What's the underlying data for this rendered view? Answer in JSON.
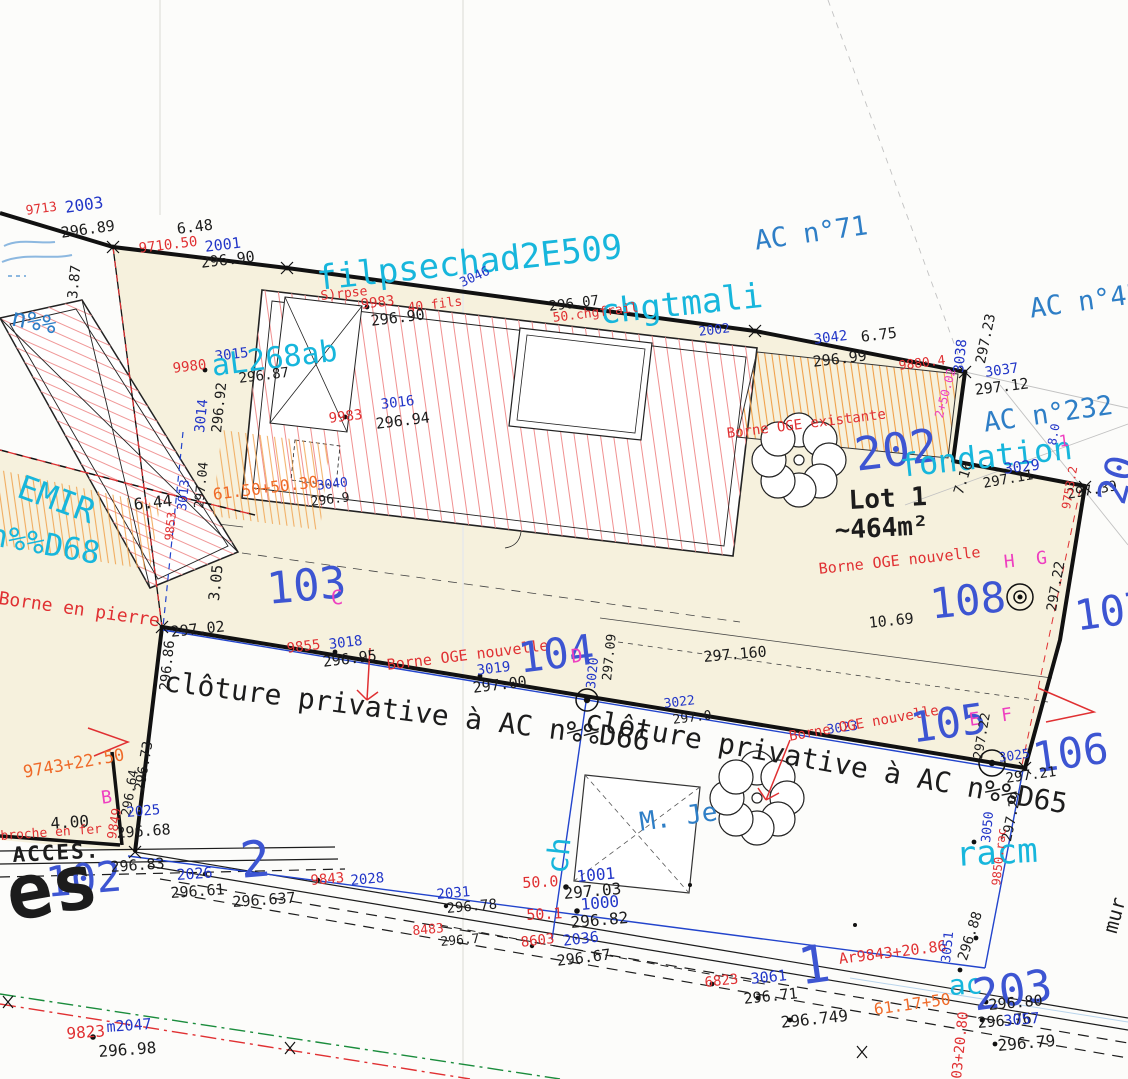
{
  "palette": {
    "point_blue": "#2236c8",
    "survey_red": "#e03032",
    "survey_orange": "#ef6a28",
    "ink_black": "#1c1c1c",
    "overlay_cyan": "#17b6dc",
    "axis_magenta": "#ee3fc0",
    "parcel_ref_blue": "#2e7ec6",
    "parcel_num_blue": "#3d55d2",
    "parcel_beige": "#f6f1dd",
    "hatch_red": "#f09090",
    "hatch_orange": "#f0a048",
    "fence_blue": "#2244cc",
    "axis_green": "#1a8c3c"
  },
  "labels": [
    {
      "t": "9713",
      "x": 25,
      "y": 205,
      "s": 13,
      "c": "red",
      "r": -8
    },
    {
      "t": "2003",
      "x": 64,
      "y": 200,
      "s": 16,
      "c": "blue",
      "r": -8
    },
    {
      "t": "296.89",
      "x": 60,
      "y": 226,
      "s": 15,
      "c": "black",
      "r": -8
    },
    {
      "t": "6.48",
      "x": 176,
      "y": 222,
      "s": 15,
      "c": "black",
      "r": -7,
      "n": "distance-label"
    },
    {
      "t": "9710.50",
      "x": 138,
      "y": 242,
      "s": 14,
      "c": "red",
      "r": -7
    },
    {
      "t": "2001",
      "x": 204,
      "y": 240,
      "s": 15,
      "c": "blue",
      "r": -7
    },
    {
      "t": "296.90",
      "x": 200,
      "y": 256,
      "s": 15,
      "c": "black",
      "r": -7
    },
    {
      "t": "3.87",
      "x": 66,
      "y": 298,
      "s": 14,
      "c": "black",
      "r": -84,
      "n": "distance-label"
    },
    {
      "t": "AC n°71",
      "x": 753,
      "y": 228,
      "s": 27,
      "c": "ac",
      "r": -8
    },
    {
      "t": "AC n°45",
      "x": 1028,
      "y": 296,
      "s": 27,
      "c": "ac",
      "r": -8
    },
    {
      "t": "AC n°232",
      "x": 982,
      "y": 410,
      "s": 27,
      "c": "ac",
      "r": -8
    },
    {
      "t": "filpsechad2E509",
      "x": 315,
      "y": 262,
      "s": 34,
      "c": "cyan",
      "r": -6
    },
    {
      "t": "chgtmali",
      "x": 598,
      "y": 296,
      "s": 34,
      "c": "cyan",
      "r": -6
    },
    {
      "t": "S)rpse",
      "x": 320,
      "y": 290,
      "s": 13,
      "c": "red",
      "r": -6
    },
    {
      "t": "9983",
      "x": 360,
      "y": 298,
      "s": 14,
      "c": "red",
      "r": -7
    },
    {
      "t": "40 fils",
      "x": 407,
      "y": 302,
      "s": 13,
      "c": "red",
      "r": -7
    },
    {
      "t": "296.90",
      "x": 370,
      "y": 314,
      "s": 15,
      "c": "black",
      "r": -7
    },
    {
      "t": "296.07",
      "x": 548,
      "y": 300,
      "s": 14,
      "c": "black",
      "r": -7
    },
    {
      "t": "50.chgfrail",
      "x": 552,
      "y": 312,
      "s": 13,
      "c": "red",
      "r": -7
    },
    {
      "t": "2002",
      "x": 698,
      "y": 326,
      "s": 13,
      "c": "blue",
      "r": -7
    },
    {
      "t": "3046",
      "x": 458,
      "y": 278,
      "s": 13,
      "c": "blue",
      "r": -25
    },
    {
      "t": "3042",
      "x": 813,
      "y": 333,
      "s": 14,
      "c": "blue",
      "r": -7
    },
    {
      "t": "6.75",
      "x": 860,
      "y": 330,
      "s": 15,
      "c": "black",
      "r": -7,
      "n": "distance-label"
    },
    {
      "t": "296.99",
      "x": 812,
      "y": 355,
      "s": 15,
      "c": "black",
      "r": -7
    },
    {
      "t": "9880.4",
      "x": 898,
      "y": 360,
      "s": 13,
      "c": "red",
      "r": -7
    },
    {
      "t": "3038",
      "x": 952,
      "y": 372,
      "s": 14,
      "c": "blue",
      "r": -84
    },
    {
      "t": "297.23",
      "x": 974,
      "y": 362,
      "s": 14,
      "c": "black",
      "r": -78
    },
    {
      "t": "3037",
      "x": 984,
      "y": 366,
      "s": 14,
      "c": "blue",
      "r": -8
    },
    {
      "t": "297.12",
      "x": 974,
      "y": 383,
      "s": 15,
      "c": "black",
      "r": -7
    },
    {
      "t": "9980",
      "x": 172,
      "y": 362,
      "s": 14,
      "c": "red",
      "r": -7
    },
    {
      "t": "3015",
      "x": 214,
      "y": 350,
      "s": 14,
      "c": "blue",
      "r": -7
    },
    {
      "t": "aL268ab",
      "x": 210,
      "y": 352,
      "s": 30,
      "c": "cyan",
      "r": -7
    },
    {
      "t": "296.87",
      "x": 238,
      "y": 372,
      "s": 14,
      "c": "black",
      "r": -7
    },
    {
      "t": "3014",
      "x": 193,
      "y": 432,
      "s": 14,
      "c": "blue",
      "r": -84
    },
    {
      "t": "296.92",
      "x": 210,
      "y": 432,
      "s": 14,
      "c": "black",
      "r": -84
    },
    {
      "t": "9983",
      "x": 328,
      "y": 412,
      "s": 14,
      "c": "red",
      "r": -7
    },
    {
      "t": "3016",
      "x": 380,
      "y": 398,
      "s": 14,
      "c": "blue",
      "r": -7
    },
    {
      "t": "296.94",
      "x": 375,
      "y": 417,
      "s": 15,
      "c": "black",
      "r": -7
    },
    {
      "t": "AC n%%",
      "x": -30,
      "y": 296,
      "s": 25,
      "c": "ac",
      "r": 11
    },
    {
      "t": "EMIR",
      "x": 25,
      "y": 470,
      "s": 33,
      "c": "cyan",
      "r": 20
    },
    {
      "t": "n%%D68",
      "x": -8,
      "y": 520,
      "s": 31,
      "c": "cyan",
      "r": 10
    },
    {
      "t": "103",
      "x": 265,
      "y": 568,
      "s": 44,
      "c": "big",
      "r": -5
    },
    {
      "t": "C",
      "x": 330,
      "y": 588,
      "s": 20,
      "c": "mag",
      "r": -5
    },
    {
      "t": "Borne en pierre",
      "x": 0,
      "y": 590,
      "s": 18,
      "c": "red",
      "r": 8,
      "n": "borne-annotation-label"
    },
    {
      "t": "6.44",
      "x": 133,
      "y": 497,
      "s": 16,
      "c": "black",
      "r": -6,
      "n": "distance-label"
    },
    {
      "t": "3.05",
      "x": 207,
      "y": 600,
      "s": 15,
      "c": "black",
      "r": -84,
      "n": "distance-label"
    },
    {
      "t": "3013",
      "x": 176,
      "y": 510,
      "s": 13,
      "c": "blue",
      "r": -84
    },
    {
      "t": "297.04",
      "x": 193,
      "y": 508,
      "s": 13,
      "c": "black",
      "r": -84
    },
    {
      "t": "9853",
      "x": 163,
      "y": 540,
      "s": 12,
      "c": "red",
      "r": -84
    },
    {
      "t": "61.50+50.30",
      "x": 212,
      "y": 487,
      "s": 16,
      "c": "orange",
      "r": -7
    },
    {
      "t": "3040",
      "x": 316,
      "y": 480,
      "s": 13,
      "c": "blue",
      "r": -7
    },
    {
      "t": "296.9",
      "x": 310,
      "y": 496,
      "s": 13,
      "c": "black",
      "r": -7
    },
    {
      "t": "Borne OGE existante",
      "x": 726,
      "y": 427,
      "s": 14,
      "c": "red",
      "r": -7,
      "n": "borne-annotation-label"
    },
    {
      "t": "202",
      "x": 852,
      "y": 432,
      "s": 46,
      "c": "big",
      "r": -7
    },
    {
      "t": "fondation",
      "x": 898,
      "y": 450,
      "s": 32,
      "c": "cyan",
      "r": -6
    },
    {
      "t": "3029",
      "x": 1003,
      "y": 462,
      "s": 15,
      "c": "blue",
      "r": -7
    },
    {
      "t": "297.11",
      "x": 982,
      "y": 477,
      "s": 14,
      "c": "black",
      "r": -10
    },
    {
      "t": "297.39",
      "x": 1066,
      "y": 488,
      "s": 14,
      "c": "black",
      "r": -10
    },
    {
      "t": "20",
      "x": 1092,
      "y": 498,
      "s": 40,
      "c": "big",
      "r": -75
    },
    {
      "t": "1",
      "x": 1058,
      "y": 434,
      "s": 16,
      "c": "mag",
      "r": -7
    },
    {
      "t": "8.0",
      "x": 1046,
      "y": 444,
      "s": 12,
      "c": "blue",
      "r": -80
    },
    {
      "t": "2+50.02",
      "x": 933,
      "y": 416,
      "s": 12,
      "c": "mag",
      "r": -75
    },
    {
      "t": "9753.2",
      "x": 1060,
      "y": 508,
      "s": 12,
      "c": "red",
      "r": -80
    },
    {
      "t": "Lot 1",
      "x": 848,
      "y": 488,
      "s": 26,
      "c": "black",
      "r": -3,
      "b": 1,
      "n": "lot-name-label"
    },
    {
      "t": "~464m²",
      "x": 834,
      "y": 518,
      "s": 26,
      "c": "black",
      "r": -3,
      "b": 1,
      "n": "lot-area-label"
    },
    {
      "t": "7.16",
      "x": 952,
      "y": 492,
      "s": 14,
      "c": "black",
      "r": -72,
      "n": "distance-label"
    },
    {
      "t": "Borne OGE nouvelle",
      "x": 818,
      "y": 562,
      "s": 15,
      "c": "red",
      "r": -6,
      "n": "borne-annotation-label"
    },
    {
      "t": "H  G",
      "x": 1003,
      "y": 554,
      "s": 18,
      "c": "mag",
      "r": -6
    },
    {
      "t": "108",
      "x": 928,
      "y": 584,
      "s": 42,
      "c": "big",
      "r": -6
    },
    {
      "t": "297.22",
      "x": 1045,
      "y": 610,
      "s": 14,
      "c": "black",
      "r": -80
    },
    {
      "t": "107",
      "x": 1072,
      "y": 596,
      "s": 42,
      "c": "big",
      "r": -8
    },
    {
      "t": "10.69",
      "x": 868,
      "y": 616,
      "s": 15,
      "c": "black",
      "r": -6,
      "n": "distance-label"
    },
    {
      "t": "297.160",
      "x": 703,
      "y": 650,
      "s": 15,
      "c": "black",
      "r": -5
    },
    {
      "t": "297.02",
      "x": 170,
      "y": 625,
      "s": 15,
      "c": "black",
      "r": -6
    },
    {
      "t": "296.86",
      "x": 158,
      "y": 690,
      "s": 14,
      "c": "black",
      "r": -84
    },
    {
      "t": "9855",
      "x": 286,
      "y": 642,
      "s": 14,
      "c": "red",
      "r": -7
    },
    {
      "t": "3018",
      "x": 328,
      "y": 638,
      "s": 14,
      "c": "blue",
      "r": -7
    },
    {
      "t": "296.95",
      "x": 322,
      "y": 655,
      "s": 15,
      "c": "black",
      "r": -7
    },
    {
      "t": "Borne OGE nouvelle",
      "x": 386,
      "y": 658,
      "s": 15,
      "c": "red",
      "r": -7,
      "n": "borne-annotation-label"
    },
    {
      "t": "3019",
      "x": 476,
      "y": 664,
      "s": 14,
      "c": "blue",
      "r": -7
    },
    {
      "t": "297.00",
      "x": 472,
      "y": 681,
      "s": 15,
      "c": "black",
      "r": -7
    },
    {
      "t": "104",
      "x": 516,
      "y": 638,
      "s": 42,
      "c": "big",
      "r": -7
    },
    {
      "t": "D",
      "x": 570,
      "y": 648,
      "s": 19,
      "c": "mag",
      "r": -7
    },
    {
      "t": "3020",
      "x": 585,
      "y": 688,
      "s": 13,
      "c": "blue",
      "r": -84
    },
    {
      "t": "297.09",
      "x": 601,
      "y": 680,
      "s": 13,
      "c": "black",
      "r": -84
    },
    {
      "t": "clôture privative à AC n%%D66",
      "x": 166,
      "y": 668,
      "s": 28,
      "c": "black",
      "r": 7,
      "n": "fence-annotation-label"
    },
    {
      "t": "clôture privative à AC n%%D65",
      "x": 588,
      "y": 706,
      "s": 28,
      "c": "black",
      "r": 10,
      "n": "fence-annotation-label"
    },
    {
      "t": "3022",
      "x": 663,
      "y": 698,
      "s": 13,
      "c": "blue",
      "r": -7
    },
    {
      "t": "297.0",
      "x": 672,
      "y": 714,
      "s": 13,
      "c": "black",
      "r": -7
    },
    {
      "t": "3023",
      "x": 826,
      "y": 724,
      "s": 13,
      "c": "blue",
      "r": -8
    },
    {
      "t": "Borne OGE nouvelle",
      "x": 788,
      "y": 730,
      "s": 14,
      "c": "red",
      "r": -10,
      "n": "borne-annotation-label"
    },
    {
      "t": "105",
      "x": 908,
      "y": 708,
      "s": 42,
      "c": "big",
      "r": -8
    },
    {
      "t": "E  F",
      "x": 968,
      "y": 712,
      "s": 18,
      "c": "mag",
      "r": -8
    },
    {
      "t": "106",
      "x": 1030,
      "y": 738,
      "s": 42,
      "c": "big",
      "r": -8
    },
    {
      "t": "297.22",
      "x": 972,
      "y": 758,
      "s": 13,
      "c": "black",
      "r": -80
    },
    {
      "t": "3025",
      "x": 998,
      "y": 752,
      "s": 13,
      "c": "blue",
      "r": -8
    },
    {
      "t": "297.21",
      "x": 1005,
      "y": 772,
      "s": 14,
      "c": "black",
      "r": -8
    },
    {
      "t": "9743+22.50",
      "x": 22,
      "y": 765,
      "s": 17,
      "c": "orange",
      "r": -10
    },
    {
      "t": "B",
      "x": 100,
      "y": 790,
      "s": 18,
      "c": "mag",
      "r": -8
    },
    {
      "t": "4.00",
      "x": 50,
      "y": 816,
      "s": 16,
      "c": "black",
      "r": -4,
      "n": "distance-label"
    },
    {
      "t": "broche en fer",
      "x": 0,
      "y": 830,
      "s": 13,
      "c": "red",
      "r": -4,
      "n": "borne-annotation-label"
    },
    {
      "t": "ACCES.",
      "x": 12,
      "y": 845,
      "s": 21,
      "c": "black",
      "r": -3,
      "b": 1,
      "ls": 2,
      "n": "access-label"
    },
    {
      "t": "102",
      "x": 44,
      "y": 862,
      "s": 42,
      "c": "big",
      "r": -5
    },
    {
      "t": "es",
      "x": 0,
      "y": 858,
      "s": 76,
      "c": "black",
      "r": -10,
      "b": 1,
      "n": "street-name-fragment-label"
    },
    {
      "t": "296.73",
      "x": 133,
      "y": 790,
      "s": 14,
      "c": "black",
      "r": -80
    },
    {
      "t": "296.64",
      "x": 120,
      "y": 815,
      "s": 13,
      "c": "black",
      "r": -80
    },
    {
      "t": "9849",
      "x": 106,
      "y": 838,
      "s": 13,
      "c": "red",
      "r": -80
    },
    {
      "t": "2025",
      "x": 126,
      "y": 806,
      "s": 14,
      "c": "blue",
      "r": -5
    },
    {
      "t": "296.68",
      "x": 116,
      "y": 826,
      "s": 15,
      "c": "black",
      "r": -4
    },
    {
      "t": "296.83",
      "x": 110,
      "y": 860,
      "s": 15,
      "c": "black",
      "r": -4
    },
    {
      "t": "2026",
      "x": 176,
      "y": 868,
      "s": 15,
      "c": "blue",
      "r": -4
    },
    {
      "t": "296.61",
      "x": 170,
      "y": 886,
      "s": 15,
      "c": "black",
      "r": -4
    },
    {
      "t": "296.637",
      "x": 232,
      "y": 895,
      "s": 15,
      "c": "black",
      "r": -4
    },
    {
      "t": "2",
      "x": 238,
      "y": 836,
      "s": 50,
      "c": "big",
      "r": -5
    },
    {
      "t": "9843",
      "x": 310,
      "y": 874,
      "s": 14,
      "c": "red",
      "r": -5
    },
    {
      "t": "2028",
      "x": 350,
      "y": 874,
      "s": 14,
      "c": "blue",
      "r": -5
    },
    {
      "t": "2031",
      "x": 436,
      "y": 888,
      "s": 14,
      "c": "blue",
      "r": -5
    },
    {
      "t": "296.78",
      "x": 446,
      "y": 902,
      "s": 14,
      "c": "black",
      "r": -5
    },
    {
      "t": "8483",
      "x": 412,
      "y": 925,
      "s": 13,
      "c": "red",
      "r": -5
    },
    {
      "t": "296.7",
      "x": 440,
      "y": 936,
      "s": 13,
      "c": "black",
      "r": -5
    },
    {
      "t": "8603",
      "x": 520,
      "y": 936,
      "s": 14,
      "c": "red",
      "r": -7
    },
    {
      "t": "2036",
      "x": 562,
      "y": 934,
      "s": 15,
      "c": "blue",
      "r": -7
    },
    {
      "t": "296.67",
      "x": 556,
      "y": 954,
      "s": 15,
      "c": "black",
      "r": -7
    },
    {
      "t": "50.0",
      "x": 522,
      "y": 876,
      "s": 15,
      "c": "red",
      "r": -3
    },
    {
      "t": "50.1",
      "x": 526,
      "y": 908,
      "s": 15,
      "c": "red",
      "r": -3
    },
    {
      "t": "ch",
      "x": 543,
      "y": 872,
      "s": 30,
      "c": "cyan",
      "r": -84
    },
    {
      "t": "1001",
      "x": 576,
      "y": 869,
      "s": 16,
      "c": "blue",
      "r": -5
    },
    {
      "t": "297.03",
      "x": 563,
      "y": 886,
      "s": 16,
      "c": "black",
      "r": -5
    },
    {
      "t": "1000",
      "x": 580,
      "y": 897,
      "s": 16,
      "c": "blue",
      "r": -5
    },
    {
      "t": "296.82",
      "x": 570,
      "y": 915,
      "s": 16,
      "c": "black",
      "r": -5
    },
    {
      "t": "M. Je",
      "x": 638,
      "y": 810,
      "s": 26,
      "c": "ac",
      "r": -8,
      "n": "owner-name-label"
    },
    {
      "t": "6823",
      "x": 704,
      "y": 976,
      "s": 14,
      "c": "red",
      "r": -6
    },
    {
      "t": "3061",
      "x": 750,
      "y": 972,
      "s": 15,
      "c": "blue",
      "r": -6
    },
    {
      "t": "296.71",
      "x": 743,
      "y": 992,
      "s": 15,
      "c": "black",
      "r": -6
    },
    {
      "t": "296.749",
      "x": 780,
      "y": 1015,
      "s": 16,
      "c": "black",
      "r": -6
    },
    {
      "t": "1",
      "x": 795,
      "y": 942,
      "s": 52,
      "c": "big",
      "r": -8
    },
    {
      "t": "Ar9843+20.86",
      "x": 838,
      "y": 952,
      "s": 15,
      "c": "red",
      "r": -7
    },
    {
      "t": "61.17+50",
      "x": 873,
      "y": 1002,
      "s": 16,
      "c": "orange",
      "r": -8
    },
    {
      "t": "racm",
      "x": 955,
      "y": 838,
      "s": 34,
      "c": "cyan",
      "r": -3
    },
    {
      "t": "3050",
      "x": 980,
      "y": 842,
      "s": 13,
      "c": "blue",
      "r": -84
    },
    {
      "t": "297.29",
      "x": 1000,
      "y": 840,
      "s": 14,
      "c": "black",
      "r": -78
    },
    {
      "t": "9850.rac",
      "x": 990,
      "y": 885,
      "s": 12,
      "c": "red",
      "r": -84
    },
    {
      "t": "3051",
      "x": 940,
      "y": 962,
      "s": 13,
      "c": "blue",
      "r": -84
    },
    {
      "t": "296.88",
      "x": 956,
      "y": 958,
      "s": 14,
      "c": "black",
      "r": -72
    },
    {
      "t": "ac",
      "x": 948,
      "y": 972,
      "s": 28,
      "c": "cyan",
      "r": -3
    },
    {
      "t": "203",
      "x": 970,
      "y": 975,
      "s": 44,
      "c": "big",
      "r": -8
    },
    {
      "t": "296.80",
      "x": 988,
      "y": 998,
      "s": 15,
      "c": "black",
      "r": -5
    },
    {
      "t": "296.76",
      "x": 977,
      "y": 1016,
      "s": 15,
      "c": "black",
      "r": -5
    },
    {
      "t": "3057",
      "x": 1003,
      "y": 1014,
      "s": 15,
      "c": "blue",
      "r": -5
    },
    {
      "t": "296.79",
      "x": 997,
      "y": 1038,
      "s": 16,
      "c": "black",
      "r": -5
    },
    {
      "t": "03+20.80",
      "x": 950,
      "y": 1078,
      "s": 14,
      "c": "red",
      "r": -84
    },
    {
      "t": "mur",
      "x": 1100,
      "y": 930,
      "s": 20,
      "c": "black",
      "r": -75,
      "n": "wall-annotation-label"
    },
    {
      "t": "9823",
      "x": 66,
      "y": 1026,
      "s": 16,
      "c": "red",
      "r": -4
    },
    {
      "t": "m2047",
      "x": 106,
      "y": 1020,
      "s": 15,
      "c": "blue",
      "r": -4
    },
    {
      "t": "296.98",
      "x": 98,
      "y": 1044,
      "s": 16,
      "c": "black",
      "r": -4
    }
  ]
}
